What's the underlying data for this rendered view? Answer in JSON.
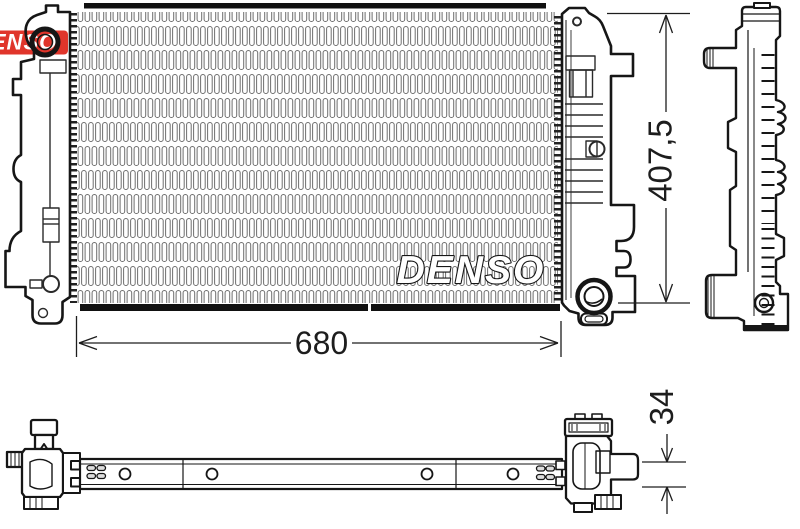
{
  "drawing": {
    "brand_watermark": "DENSO",
    "brand_logo_fragment": "DENSO",
    "colors": {
      "logo_red": "#e0352b",
      "line": "#161616",
      "fin_gray": "#6e6e6e"
    },
    "dimensions": {
      "core_width": "680",
      "overall_height": "407,5",
      "thickness": "34"
    }
  }
}
